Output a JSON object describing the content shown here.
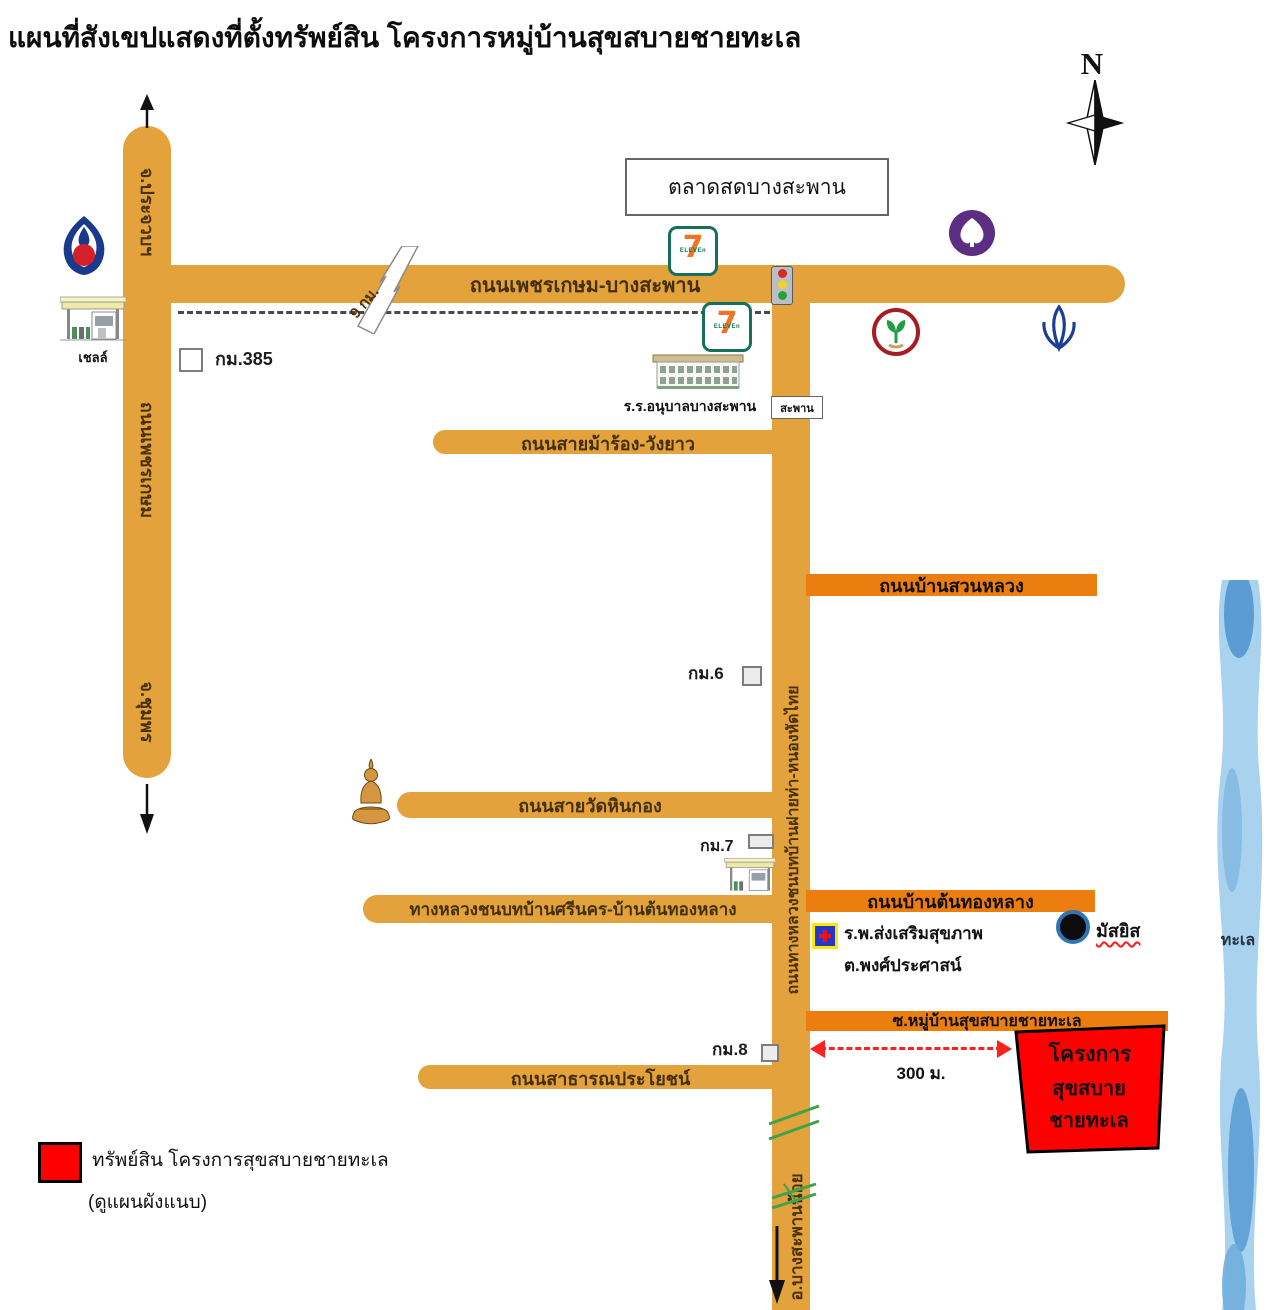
{
  "title": "แผนที่สังเขปแสดงที่ตั้งทรัพย์สิน โครงการหมู่บ้านสุขสบายชายทะเล",
  "compass": {
    "north_label": "N"
  },
  "roads": {
    "phetkasem": {
      "label": "ถนนเพชรเกษม",
      "to_north": "จ.ประจวบฯ",
      "to_south": "จ.ชุมพร"
    },
    "phetkasem_bangsaphan": {
      "label": "ถนนเพชรเกษม-บางสะพาน",
      "break_distance": "9 กม."
    },
    "marong_wangyao": {
      "label": "ถนนสายม้าร้อง-วังยาว"
    },
    "ban_suan_luang": {
      "label": "ถนนบ้านสวนหลวง"
    },
    "rural_fai_tha": {
      "label": "ถนนทางหลวงชนบทบ้านฝายท่า-หนองหัดไทย",
      "to_south": "อ.บางสะพานน้อย"
    },
    "wat_hin_kong": {
      "label": "ถนนสายวัดหินกอง"
    },
    "srinakhon_tonthonglang": {
      "label": "ทางหลวงชนบทบ้านศรีนคร-บ้านต้นทองหลาง"
    },
    "ban_ton_thong_lang": {
      "label": "ถนนบ้านต้นทองหลาง"
    },
    "soi_mubaan": {
      "label": "ซ.หมู่บ้านสุขสบายชายทะเล"
    },
    "public_benefit": {
      "label": "ถนนสาธารณประโยชน์"
    }
  },
  "landmarks": {
    "market": {
      "label": "ตลาดสดบางสะพาน"
    },
    "school": {
      "label": "ร.ร.อนุบาลบางสะพาน"
    },
    "bridge": {
      "label": "สะพาน"
    },
    "shell_station": {
      "label": "เชลล์"
    },
    "hospital": {
      "line1": "ร.พ.ส่งเสริมสุขภาพ",
      "line2": "ต.พงศ์ประศาสน์"
    },
    "mosque": {
      "label": "มัสยิส"
    },
    "sea": {
      "label": "ทะเล"
    }
  },
  "km_markers": {
    "km385": "กม.385",
    "km6": "กม.6",
    "km7": "กม.7",
    "km8": "กม.8"
  },
  "project": {
    "box_line1": "โครงการ",
    "box_line2": "สุขสบายชายทะเล",
    "distance": "300 ม."
  },
  "legend": {
    "line1": "ทรัพย์สิน โครงการสุขสบายชายทะเล",
    "line2": "(ดูแผนผังแนบ)"
  },
  "seven_eleven": {
    "digit": "7",
    "word": "ELEVEn"
  },
  "colors": {
    "road_orange": "#E3A23C",
    "road_label_bar_orange": "#EC7D0F",
    "project_red": "#FF0000",
    "river_blue": "#A9D2EE",
    "river_dark_blue": "#4E93D0",
    "scb_purple": "#5B2D83",
    "kasikorn_green": "#1F9D44",
    "kasikorn_ring_red": "#A61C22",
    "bangkok_bank_blue": "#1B3F94",
    "ptt_blue": "#1A3A8C",
    "ptt_red": "#D5202A"
  }
}
